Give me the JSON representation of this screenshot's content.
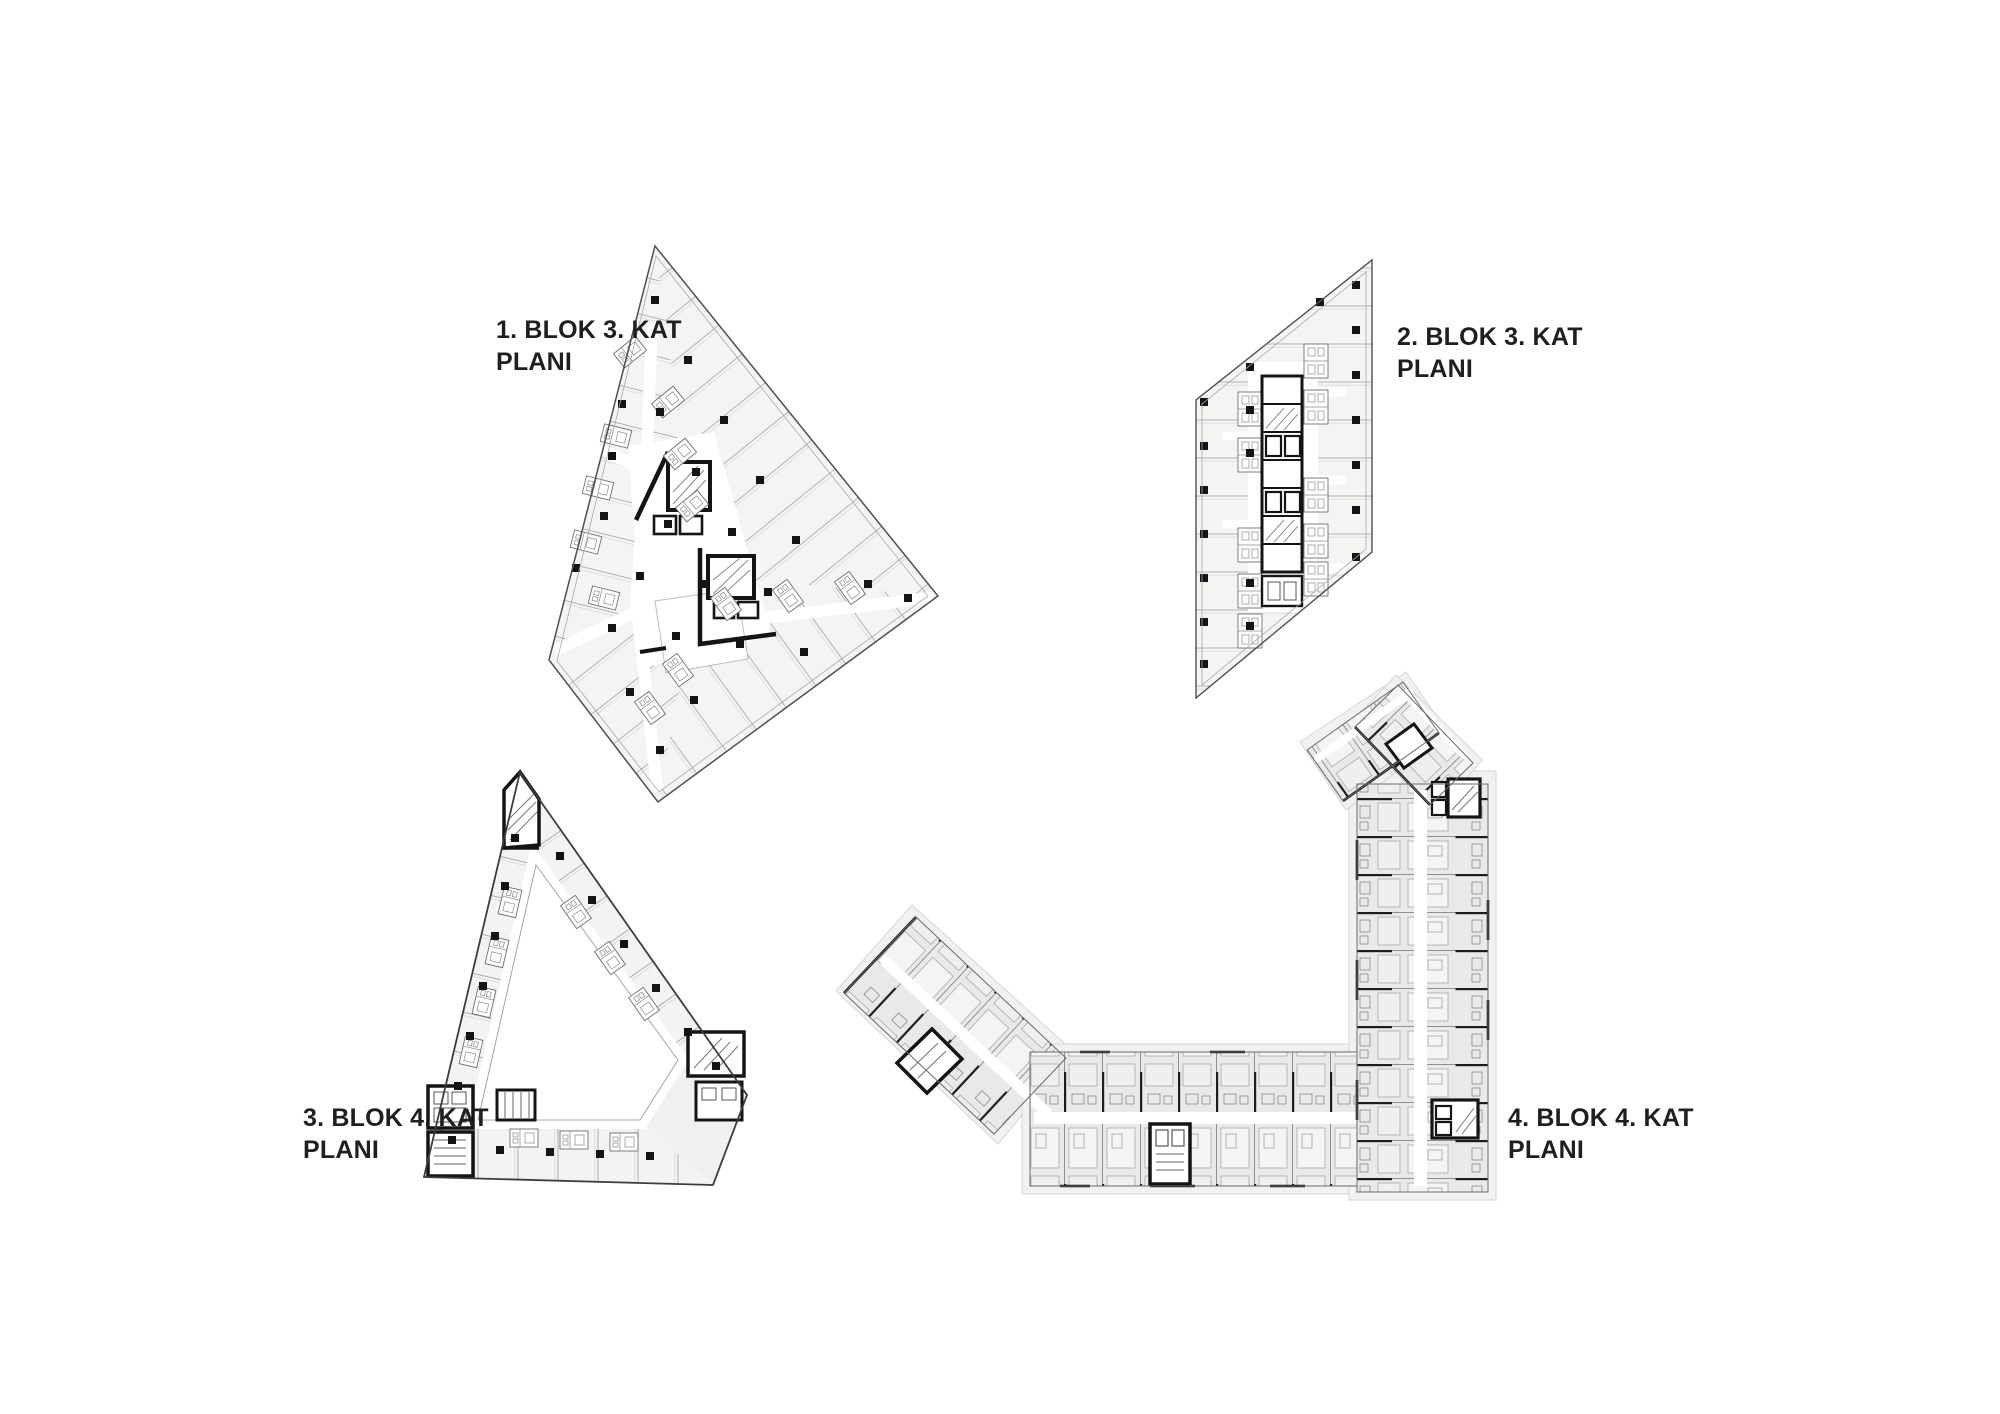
{
  "sheet": {
    "type": "architectural-floor-plan-sheet",
    "background": "#ffffff"
  },
  "plans": {
    "plan1": {
      "label_line1": "1. BLOK 3. KAT",
      "label_line2": "PLANI",
      "shape": "triangular-kite-block"
    },
    "plan2": {
      "label_line1": "2. BLOK 3. KAT",
      "label_line2": "PLANI",
      "shape": "parallelogram-block"
    },
    "plan3": {
      "label_line1": "3. BLOK 4. KAT",
      "label_line2": "PLANI",
      "shape": "triangular-courtyard-block"
    },
    "plan4": {
      "label_line1": "4. BLOK 4. KAT",
      "label_line2": "PLANI",
      "shape": "j-shaped-apartment-block"
    }
  },
  "colors": {
    "background": "#ffffff",
    "plan_fill": "#f4f4f3",
    "plan4_fill": "#e9e9e9",
    "partition_gray": "#b4b4b4",
    "outline_gray": "#4f4f4f",
    "core_black": "#141414",
    "label_text": "#1f1f1f"
  }
}
